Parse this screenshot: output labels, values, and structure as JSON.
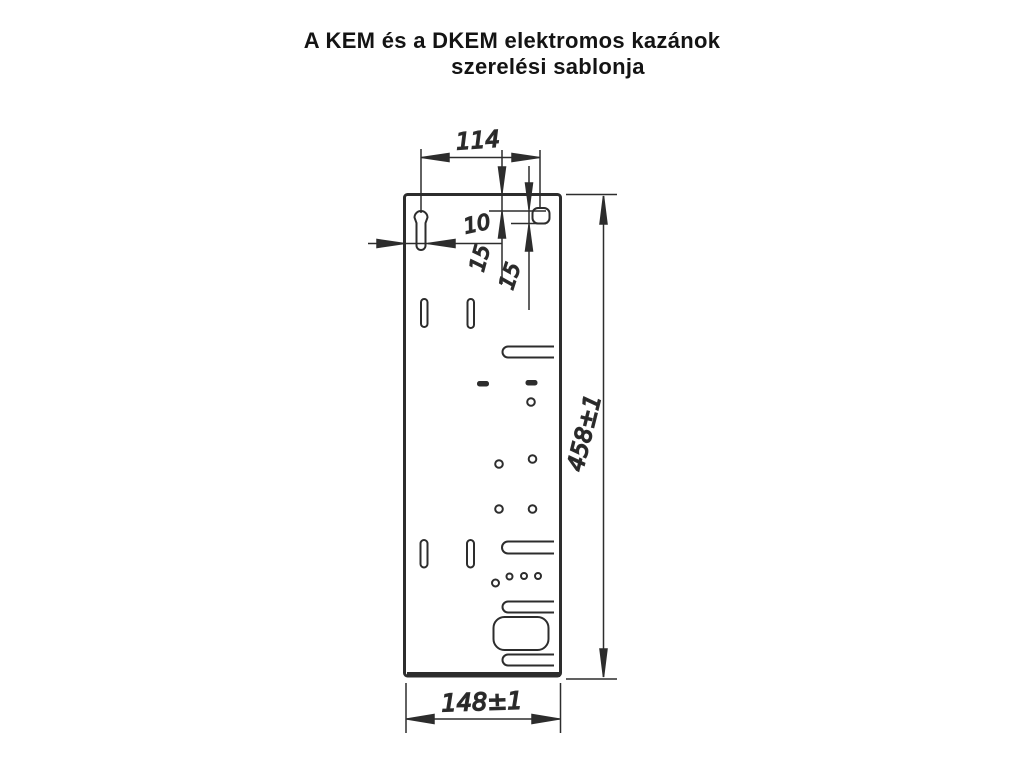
{
  "title": {
    "line1": "A KEM és a DKEM elektromos kazánok",
    "line2": "szerelési sablonja"
  },
  "drawing": {
    "labels": {
      "hole_spacing": "114",
      "top_offset": "10",
      "side_offset": "15",
      "slot_offset": "15",
      "plate_height": "458±1",
      "plate_width": "148±1"
    },
    "colors": {
      "background": "#ffffff",
      "line": "#2d2d2d",
      "text": "#111111"
    }
  }
}
